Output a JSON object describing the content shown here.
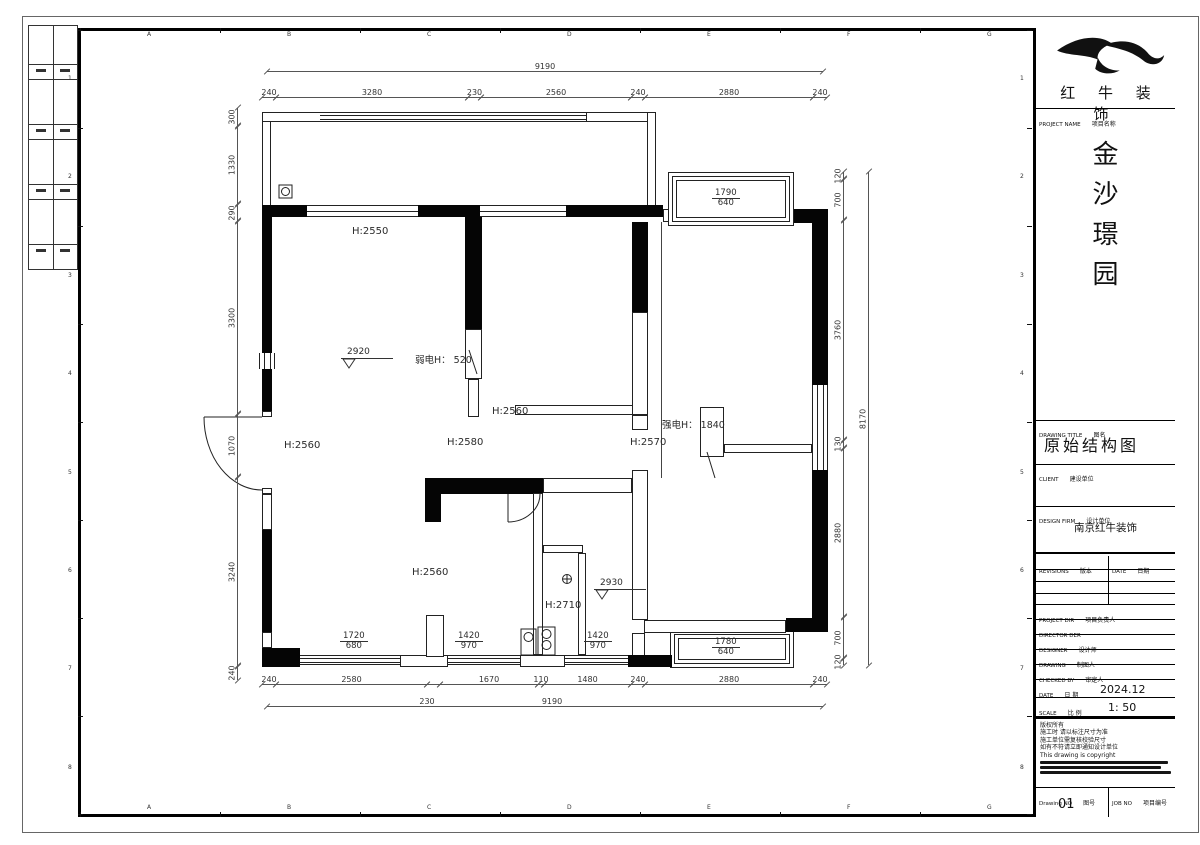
{
  "sheet": {
    "grid_letters": [
      "A",
      "B",
      "C",
      "D",
      "E",
      "F",
      "G",
      "H"
    ],
    "grid_numbers": [
      "1",
      "2",
      "3",
      "4",
      "5",
      "6",
      "7",
      "8"
    ]
  },
  "title_block": {
    "company": "红 牛 装 饰",
    "project_name_label": "PROJECT NAME",
    "project_name_label_cn": "项目名称",
    "project_name_chars": [
      "金",
      "沙",
      "璟",
      "园"
    ],
    "drawing_title_label": "DRAWING TITLE",
    "drawing_title_label_cn": "图名",
    "drawing_title": "原始结构图",
    "client_label": "CLIENT",
    "client_label_cn": "建设单位",
    "design_firm_label": "DESIGN FIRM",
    "design_firm_label_cn": "设计单位",
    "design_firm": "南京红牛装饰",
    "revisions_label": "REVISIONS",
    "revisions_label_cn": "版本",
    "revisions_date_label": "DATE",
    "revisions_date_label_cn": "日期",
    "project_dir_label": "PROJECT DIR",
    "project_dir_label_cn": "项目负责人",
    "director_label": "DIRECTOR DER",
    "designer_label": "DESIGNER",
    "designer_label_cn": "设计师",
    "drawing_by_label": "DRAWING",
    "drawing_by_label_cn": "制图人",
    "checked_by_label": "CHECKED BY",
    "checked_by_label_cn": "审定人",
    "date_label": "DATE",
    "date_label_cn": "日 期",
    "date_value": "2024.12",
    "scale_label": "SCALE",
    "scale_label_cn": "比 例",
    "scale_value": "1: 50",
    "notes": [
      "版权所有",
      "施工时 请以标注尺寸为准",
      "施工单位需复核校验尺寸",
      "如有不符请立即通知设计单位",
      "This drawing is copyright"
    ],
    "drawing_no_label": "Drawing NO",
    "drawing_no_label_cn": "图号",
    "drawing_no_value": "01",
    "job_no_label": "JOB NO",
    "job_no_label_cn": "项目编号"
  },
  "plan": {
    "dims": {
      "top": [
        "240",
        "3280",
        "230",
        "2560",
        "240",
        "2880",
        "240"
      ],
      "top_overall": "9190",
      "bottom": [
        "240",
        "2580",
        "1670",
        "110",
        "1480",
        "240",
        "2880",
        "240"
      ],
      "bottom_overall": "9190",
      "bottom_overall_left": "230",
      "left": [
        "300",
        "1330",
        "290",
        "3300",
        "1070",
        "3240",
        "240"
      ],
      "right": [
        "120",
        "700",
        "3760",
        "130",
        "2880",
        "700",
        "120"
      ],
      "right_overall": "8170"
    },
    "labels": {
      "h2550": "H:2550",
      "h2560_mid": "H:2560",
      "h2580": "H:2580",
      "h2570": "H:2570",
      "h2560_left": "H:2560",
      "h2560_living": "H:2560",
      "h2710": "H:2710",
      "weak_electric": "弱电H： 520",
      "strong_electric": "强电H： 1840",
      "level_living": "2920",
      "level_bath": "2930"
    },
    "windows": {
      "top_bay": {
        "w": "1790",
        "h": "640"
      },
      "bottom_bay": {
        "w": "1780",
        "h": "640"
      },
      "win1": {
        "w": "1720",
        "h": "680"
      },
      "win2": {
        "w": "1420",
        "h": "970"
      },
      "win3": {
        "w": "1420",
        "h": "970"
      }
    }
  }
}
